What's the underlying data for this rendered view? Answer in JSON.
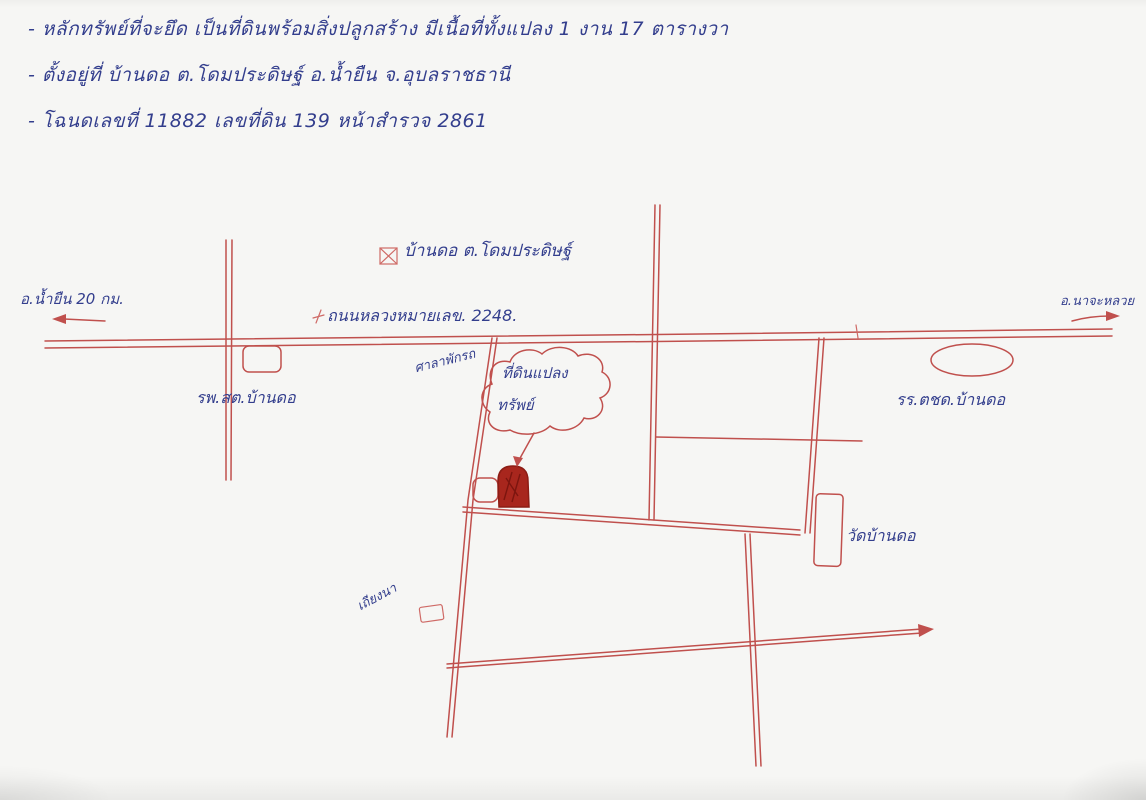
{
  "colors": {
    "ink_blue": "#333e8d",
    "ink_red": "#c0504d",
    "marker_red": "#a8261d",
    "paper": "#f6f6f4"
  },
  "notes": {
    "line1": "- หลักทรัพย์ที่จะยึด เป็นที่ดินพร้อมสิ่งปลูกสร้าง มีเนื้อที่ทั้งแปลง 1 งาน 17 ตารางวา",
    "line2": "- ตั้งอยู่ที่ บ้านดอ ต.โดมประดิษฐ์ อ.น้ำยืน จ.อุบลราชธานี",
    "line3": "- โฉนดเลขที่ 11882 เลขที่ดิน 139 หน้าสำรวจ 2861"
  },
  "map": {
    "village_marker_label": "บ้านดอ ต.โดมประดิษฐ์",
    "west_direction_label": "อ.น้ำยืน 20 กม.",
    "east_direction_label": "อ.นาจะหลวย",
    "highway_label": "ถนนหลวงหมายเลข. 2248.",
    "health_center_label": "รพ.สต.บ้านดอ",
    "shelter_label": "ศาลาพักรถ",
    "cloud_line1": "ที่ดินแปลง",
    "cloud_line2": "ทรัพย์",
    "school_label": "รร.ตชด.บ้านดอ",
    "temple_label": "วัดบ้านดอ",
    "field_hut_label": "เถียงนา"
  }
}
